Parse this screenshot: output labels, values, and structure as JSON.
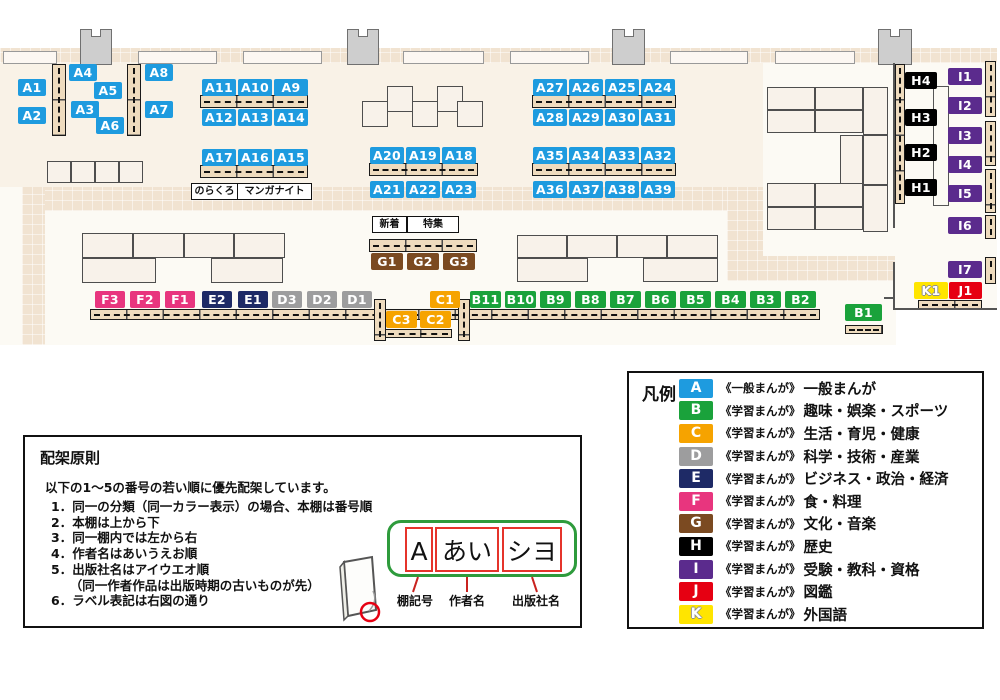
{
  "map": {
    "categories": {
      "A": {
        "color": "#1E9BDF",
        "series": "《一般まんが》",
        "label": "一般まんが"
      },
      "B": {
        "color": "#1AA23B",
        "series": "《学習まんが》",
        "label": "趣味・娯楽・スポーツ"
      },
      "C": {
        "color": "#F6A300",
        "series": "《学習まんが》",
        "label": "生活・育児・健康"
      },
      "D": {
        "color": "#9D9D9E",
        "series": "《学習まんが》",
        "label": "科学・技術・産業"
      },
      "E": {
        "color": "#1E2A66",
        "series": "《学習まんが》",
        "label": "ビジネス・政治・経済"
      },
      "F": {
        "color": "#E8357E",
        "series": "《学習まんが》",
        "label": "食・料理"
      },
      "G": {
        "color": "#7B4A21",
        "series": "《学習まんが》",
        "label": "文化・音楽"
      },
      "H": {
        "color": "#000000",
        "series": "《学習まんが》",
        "label": "歴史"
      },
      "I": {
        "color": "#5B2B8D",
        "series": "《学習まんが》",
        "label": "受験・教科・資格"
      },
      "J": {
        "color": "#E60012",
        "series": "《学習まんが》",
        "label": "図鑑"
      },
      "K": {
        "color": "#FFE500",
        "series": "《学習まんが》",
        "label": "外国語"
      }
    },
    "shelf_labels": [
      {
        "id": "A1",
        "x": 18,
        "y": 79,
        "w": 28
      },
      {
        "id": "A2",
        "x": 18,
        "y": 107,
        "w": 28
      },
      {
        "id": "A4",
        "x": 69,
        "y": 64,
        "w": 28
      },
      {
        "id": "A3",
        "x": 71,
        "y": 101,
        "w": 28
      },
      {
        "id": "A5",
        "x": 94,
        "y": 82,
        "w": 28
      },
      {
        "id": "A6",
        "x": 96,
        "y": 117,
        "w": 28
      },
      {
        "id": "A8",
        "x": 145,
        "y": 64,
        "w": 28
      },
      {
        "id": "A7",
        "x": 145,
        "y": 101,
        "w": 28
      },
      {
        "id": "A11",
        "x": 202,
        "y": 79,
        "w": 34
      },
      {
        "id": "A10",
        "x": 238,
        "y": 79,
        "w": 34
      },
      {
        "id": "A9",
        "x": 274,
        "y": 79,
        "w": 34
      },
      {
        "id": "A12",
        "x": 202,
        "y": 109,
        "w": 34
      },
      {
        "id": "A13",
        "x": 238,
        "y": 109,
        "w": 34
      },
      {
        "id": "A14",
        "x": 274,
        "y": 109,
        "w": 34
      },
      {
        "id": "A17",
        "x": 202,
        "y": 149,
        "w": 34
      },
      {
        "id": "A16",
        "x": 238,
        "y": 149,
        "w": 34
      },
      {
        "id": "A15",
        "x": 274,
        "y": 149,
        "w": 34
      },
      {
        "id": "A20",
        "x": 370,
        "y": 147,
        "w": 34
      },
      {
        "id": "A19",
        "x": 406,
        "y": 147,
        "w": 34
      },
      {
        "id": "A18",
        "x": 442,
        "y": 147,
        "w": 34
      },
      {
        "id": "A21",
        "x": 370,
        "y": 181,
        "w": 34
      },
      {
        "id": "A22",
        "x": 406,
        "y": 181,
        "w": 34
      },
      {
        "id": "A23",
        "x": 442,
        "y": 181,
        "w": 34
      },
      {
        "id": "A27",
        "x": 533,
        "y": 79,
        "w": 34
      },
      {
        "id": "A26",
        "x": 569,
        "y": 79,
        "w": 34
      },
      {
        "id": "A25",
        "x": 605,
        "y": 79,
        "w": 34
      },
      {
        "id": "A24",
        "x": 641,
        "y": 79,
        "w": 34
      },
      {
        "id": "A28",
        "x": 533,
        "y": 109,
        "w": 34
      },
      {
        "id": "A29",
        "x": 569,
        "y": 109,
        "w": 34
      },
      {
        "id": "A30",
        "x": 605,
        "y": 109,
        "w": 34
      },
      {
        "id": "A31",
        "x": 641,
        "y": 109,
        "w": 34
      },
      {
        "id": "A35",
        "x": 533,
        "y": 147,
        "w": 34
      },
      {
        "id": "A34",
        "x": 569,
        "y": 147,
        "w": 34
      },
      {
        "id": "A33",
        "x": 605,
        "y": 147,
        "w": 34
      },
      {
        "id": "A32",
        "x": 641,
        "y": 147,
        "w": 34
      },
      {
        "id": "A36",
        "x": 533,
        "y": 181,
        "w": 34
      },
      {
        "id": "A37",
        "x": 569,
        "y": 181,
        "w": 34
      },
      {
        "id": "A38",
        "x": 605,
        "y": 181,
        "w": 34
      },
      {
        "id": "A39",
        "x": 641,
        "y": 181,
        "w": 34
      },
      {
        "id": "G1",
        "x": 371,
        "y": 253,
        "w": 32
      },
      {
        "id": "G2",
        "x": 407,
        "y": 253,
        "w": 32
      },
      {
        "id": "G3",
        "x": 443,
        "y": 253,
        "w": 32
      },
      {
        "id": "F3",
        "x": 95,
        "y": 291,
        "w": 30
      },
      {
        "id": "F2",
        "x": 130,
        "y": 291,
        "w": 30
      },
      {
        "id": "F1",
        "x": 165,
        "y": 291,
        "w": 30
      },
      {
        "id": "E2",
        "x": 202,
        "y": 291,
        "w": 30
      },
      {
        "id": "E1",
        "x": 238,
        "y": 291,
        "w": 30
      },
      {
        "id": "D3",
        "x": 272,
        "y": 291,
        "w": 30
      },
      {
        "id": "D2",
        "x": 307,
        "y": 291,
        "w": 30
      },
      {
        "id": "D1",
        "x": 342,
        "y": 291,
        "w": 30
      },
      {
        "id": "C1",
        "x": 430,
        "y": 291,
        "w": 30
      },
      {
        "id": "B11",
        "x": 470,
        "y": 291,
        "w": 31
      },
      {
        "id": "B10",
        "x": 505,
        "y": 291,
        "w": 31
      },
      {
        "id": "B9",
        "x": 540,
        "y": 291,
        "w": 31
      },
      {
        "id": "B8",
        "x": 575,
        "y": 291,
        "w": 31
      },
      {
        "id": "B7",
        "x": 610,
        "y": 291,
        "w": 31
      },
      {
        "id": "B6",
        "x": 645,
        "y": 291,
        "w": 31
      },
      {
        "id": "B5",
        "x": 680,
        "y": 291,
        "w": 31
      },
      {
        "id": "B4",
        "x": 715,
        "y": 291,
        "w": 31
      },
      {
        "id": "B3",
        "x": 750,
        "y": 291,
        "w": 31
      },
      {
        "id": "B2",
        "x": 785,
        "y": 291,
        "w": 31
      },
      {
        "id": "C3",
        "x": 386,
        "y": 311,
        "w": 31
      },
      {
        "id": "C2",
        "x": 420,
        "y": 311,
        "w": 31
      },
      {
        "id": "B1",
        "x": 845,
        "y": 304,
        "w": 37
      },
      {
        "id": "H4",
        "x": 905,
        "y": 72,
        "w": 32
      },
      {
        "id": "H3",
        "x": 905,
        "y": 109,
        "w": 32
      },
      {
        "id": "H2",
        "x": 905,
        "y": 144,
        "w": 32
      },
      {
        "id": "H1",
        "x": 905,
        "y": 179,
        "w": 32
      },
      {
        "id": "I1",
        "x": 948,
        "y": 68,
        "w": 34
      },
      {
        "id": "I2",
        "x": 948,
        "y": 97,
        "w": 34
      },
      {
        "id": "I3",
        "x": 948,
        "y": 127,
        "w": 34
      },
      {
        "id": "I4",
        "x": 948,
        "y": 156,
        "w": 34
      },
      {
        "id": "I5",
        "x": 948,
        "y": 185,
        "w": 34
      },
      {
        "id": "I6",
        "x": 948,
        "y": 217,
        "w": 34
      },
      {
        "id": "I7",
        "x": 948,
        "y": 261,
        "w": 34
      },
      {
        "id": "K1",
        "x": 914,
        "y": 282,
        "w": 34
      },
      {
        "id": "J1",
        "x": 949,
        "y": 282,
        "w": 33
      }
    ],
    "annotations": [
      {
        "text": "のらくろ",
        "x": 191,
        "y": 183,
        "w": 45
      },
      {
        "text": "マンガナイト",
        "x": 237,
        "y": 183,
        "w": 73
      },
      {
        "text": "新着",
        "x": 372,
        "y": 216,
        "w": 33
      },
      {
        "text": "特集",
        "x": 407,
        "y": 216,
        "w": 50
      }
    ],
    "furniture": {
      "walkways": [
        [
          22,
          187,
          741,
          24
        ],
        [
          22,
          187,
          23,
          158
        ],
        [
          727,
          187,
          36,
          94
        ],
        [
          727,
          256,
          168,
          25
        ]
      ],
      "windows": [
        [
          3,
          51,
          52,
          11
        ],
        [
          138,
          51,
          77,
          11
        ],
        [
          243,
          51,
          77,
          11
        ],
        [
          403,
          51,
          79,
          11
        ],
        [
          510,
          51,
          77,
          11
        ],
        [
          670,
          51,
          76,
          11
        ],
        [
          775,
          51,
          78,
          11
        ]
      ],
      "pillars": [
        [
          80,
          29,
          30,
          34
        ],
        [
          347,
          29,
          30,
          34
        ],
        [
          612,
          29,
          31,
          34
        ],
        [
          878,
          29,
          32,
          34
        ]
      ],
      "tables": [
        [
          47,
          161,
          24,
          22
        ],
        [
          71,
          161,
          24,
          22
        ],
        [
          95,
          161,
          24,
          22
        ],
        [
          119,
          161,
          24,
          22
        ],
        [
          362,
          101,
          26,
          26
        ],
        [
          387,
          86,
          26,
          26
        ],
        [
          412,
          101,
          26,
          26
        ],
        [
          437,
          86,
          26,
          26
        ],
        [
          457,
          101,
          26,
          26
        ],
        [
          82,
          233,
          51,
          25
        ],
        [
          133,
          233,
          51,
          25
        ],
        [
          184,
          233,
          50,
          25
        ],
        [
          234,
          233,
          51,
          25
        ],
        [
          82,
          258,
          74,
          25
        ],
        [
          211,
          258,
          72,
          25
        ],
        [
          517,
          235,
          50,
          23
        ],
        [
          567,
          235,
          50,
          23
        ],
        [
          617,
          235,
          50,
          23
        ],
        [
          667,
          235,
          51,
          23
        ],
        [
          517,
          258,
          71,
          24
        ],
        [
          643,
          258,
          75,
          24
        ],
        [
          767,
          87,
          48,
          23
        ],
        [
          815,
          87,
          48,
          23
        ],
        [
          863,
          87,
          25,
          48
        ],
        [
          767,
          110,
          48,
          23
        ],
        [
          815,
          110,
          48,
          23
        ],
        [
          840,
          135,
          23,
          50
        ],
        [
          863,
          135,
          25,
          50
        ],
        [
          767,
          183,
          48,
          24
        ],
        [
          815,
          183,
          48,
          24
        ],
        [
          767,
          207,
          48,
          23
        ],
        [
          815,
          207,
          48,
          23
        ],
        [
          863,
          185,
          25,
          47
        ]
      ],
      "shelves_h": [
        [
          200,
          95,
          108,
          13
        ],
        [
          200,
          165,
          108,
          13
        ],
        [
          369,
          163,
          109,
          13
        ],
        [
          532,
          95,
          144,
          13
        ],
        [
          532,
          163,
          144,
          13
        ],
        [
          369,
          239,
          108,
          13
        ],
        [
          90,
          309,
          730,
          11
        ],
        [
          845,
          325,
          38,
          9
        ],
        [
          918,
          300,
          64,
          9
        ],
        [
          384,
          329,
          68,
          9
        ]
      ],
      "shelves_v": [
        [
          52,
          64,
          14,
          72
        ],
        [
          127,
          64,
          14,
          72
        ],
        [
          374,
          299,
          12,
          42
        ],
        [
          458,
          299,
          12,
          42
        ],
        [
          895,
          64,
          10,
          140
        ],
        [
          985,
          61,
          11,
          56
        ],
        [
          985,
          121,
          11,
          45
        ],
        [
          985,
          169,
          11,
          44
        ],
        [
          985,
          215,
          11,
          24
        ],
        [
          985,
          257,
          11,
          27
        ]
      ],
      "outlines": [
        [
          933,
          86,
          16,
          120
        ]
      ],
      "walls": [
        [
          893,
          63,
          2,
          165
        ],
        [
          893,
          262,
          2,
          47
        ],
        [
          893,
          308,
          104,
          2
        ],
        [
          884,
          297,
          11,
          2
        ]
      ]
    }
  },
  "legend": {
    "title": "凡例",
    "order": [
      "A",
      "B",
      "C",
      "D",
      "E",
      "F",
      "G",
      "H",
      "I",
      "J",
      "K"
    ]
  },
  "principles": {
    "title": "配架原則",
    "intro": "以下の1～5の番号の若い順に優先配架しています。",
    "items": [
      "1．同一の分類（同一カラー表示）の場合、本棚は番号順",
      "2．本棚は上から下",
      "3．同一棚内では左から右",
      "4．作者名はあいうえお順",
      "5．出版社名はアイウエオ順",
      "　　（同一作者作品は出版時期の古いものが先）",
      "6．ラベル表記は右図の通り"
    ],
    "label_example": {
      "parts": [
        "A",
        "あい",
        "シヨ"
      ],
      "captions": [
        "棚記号",
        "作者名",
        "出版社名"
      ]
    }
  }
}
